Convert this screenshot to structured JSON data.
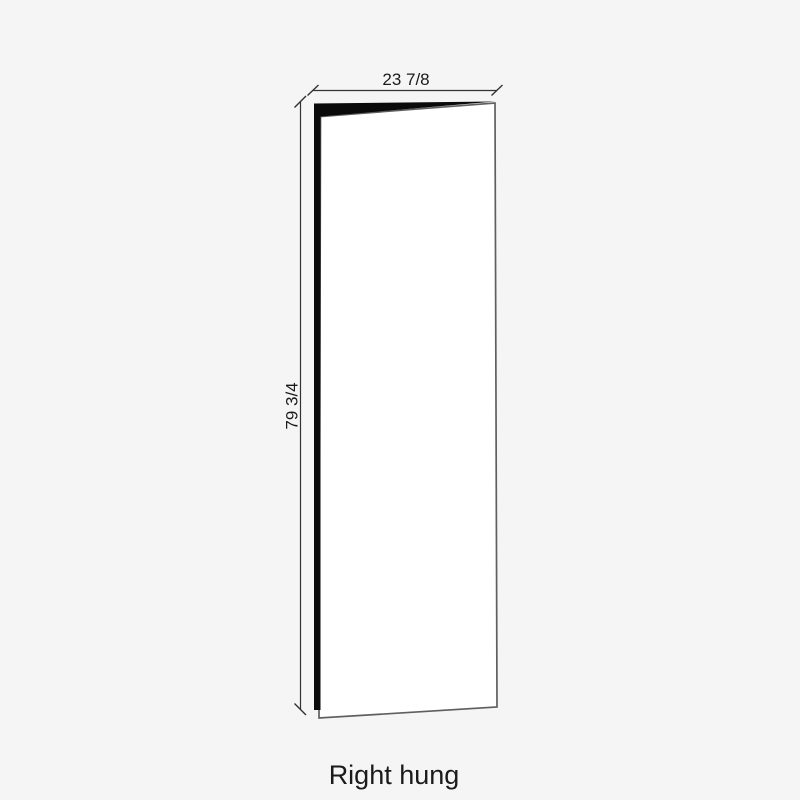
{
  "diagram": {
    "caption": "Right hung",
    "dimensions": {
      "width": {
        "label": "23 7/8"
      },
      "height": {
        "label": "79 3/4"
      }
    }
  },
  "colors": {
    "bg": "#f5f5f5",
    "ink": "#1b1b1b",
    "dim-line": "#333333",
    "door-edge-fill": "#0a0a0a",
    "door-face-fill": "#ffffff",
    "door-face-stroke": "#5f5f5f"
  }
}
